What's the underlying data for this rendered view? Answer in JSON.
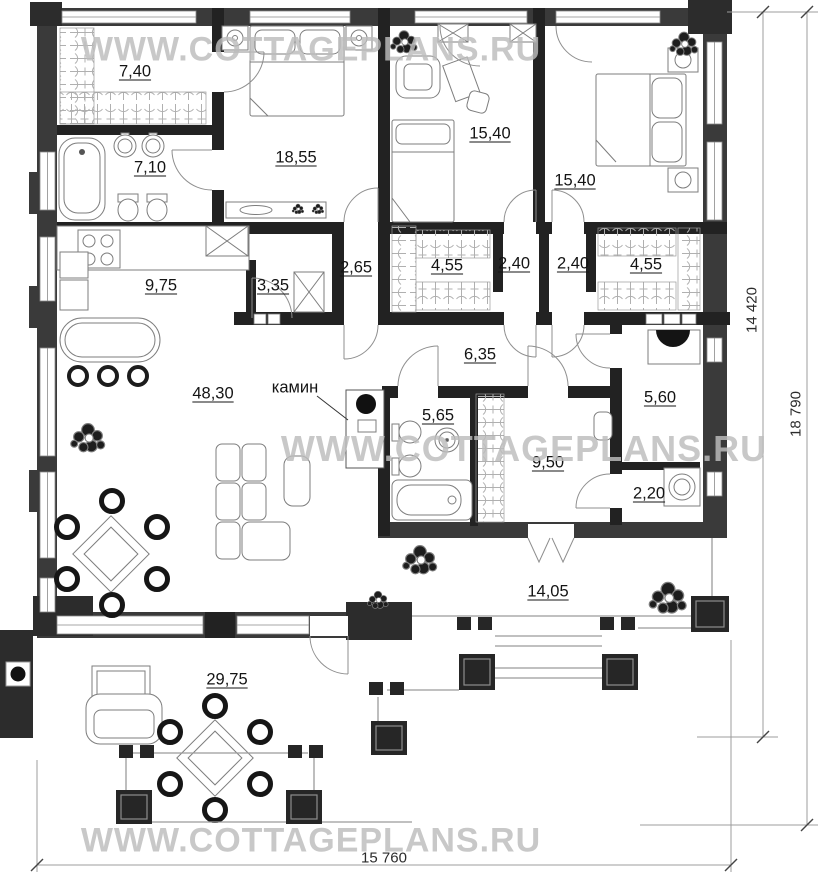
{
  "watermarks": {
    "top": "WWW.COTTAGEPLANS.RU",
    "middle": "WWW.COTTAGEPLANS.RU",
    "bottom": "WWW.COTTAGEPLANS.RU"
  },
  "rooms": {
    "wardrobe": "7,40",
    "bathroom_top": "7,10",
    "bedroom_left": "18,55",
    "bedroom_middle": "15,40",
    "bedroom_right": "15,40",
    "kitchen": "9,75",
    "hall": "3,35",
    "lobby_left": "2,65",
    "closet_left": "4,55",
    "lobby_middle": "2,40",
    "lobby_right": "2,40",
    "closet_right": "4,55",
    "corridor": "6,35",
    "living_room": "48,30",
    "bathroom_main": "5,65",
    "laundry": "9,50",
    "utility": "5,60",
    "wc": "2,20",
    "terrace_back": "14,05",
    "terrace_front": "29,75"
  },
  "annotations": {
    "fireplace": "камин"
  },
  "dimensions": {
    "inner_height": "14 420",
    "total_height": "18 790",
    "total_width": "15 760"
  }
}
